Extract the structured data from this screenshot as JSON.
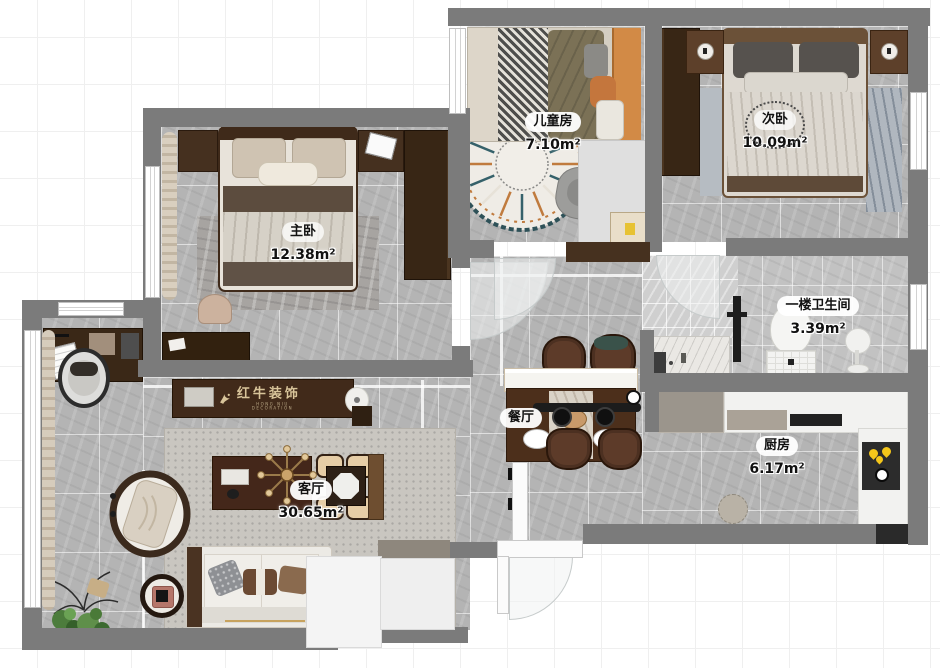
{
  "brand": {
    "logo": "红牛装饰",
    "tagline": "HONG NIU DECORATION"
  },
  "rooms": {
    "kids": {
      "name": "儿童房",
      "area": "7.10m²"
    },
    "second": {
      "name": "次卧",
      "area": "10.09m²"
    },
    "master": {
      "name": "主卧",
      "area": "12.38m²"
    },
    "bath": {
      "name": "一楼卫生间",
      "area": "3.39m²"
    },
    "dining": {
      "name": "餐厅",
      "area": ""
    },
    "kitchen": {
      "name": "厨房",
      "area": "6.17m²"
    },
    "living": {
      "name": "客厅",
      "area": "30.65m²"
    }
  },
  "colors": {
    "wall": "#7b7b7b",
    "floor": "#b4b4b4",
    "wood_dark": "#412a1a",
    "logo_text": "#d8c49a",
    "flame": "#f4c61a"
  }
}
